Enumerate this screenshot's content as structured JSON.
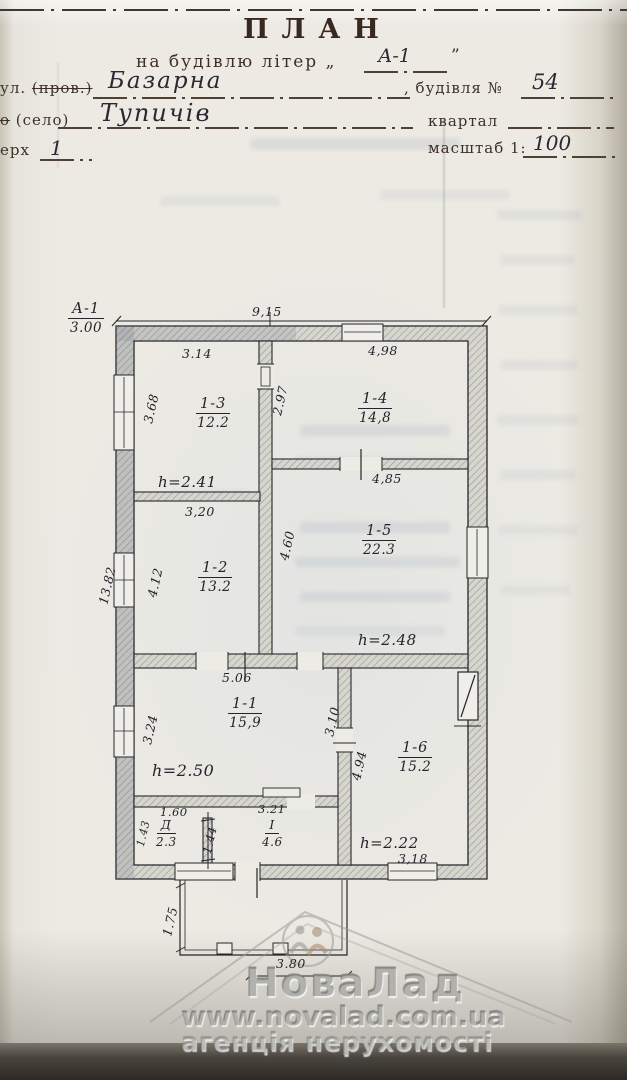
{
  "header": {
    "title": "ПЛАН",
    "subtitle": "на будівлю літер „",
    "subtitle_close_quote": "”",
    "letter_value": "А-1",
    "row_street": {
      "label_prefix": "ул. ",
      "label_struck": "(пров.)",
      "value": "Базарна",
      "right_label": ", будівля №",
      "right_value": "54"
    },
    "row_settlement": {
      "label_struck": "о",
      "label": " (село)",
      "value": "Тупичів",
      "right_label": "квартал",
      "right_value": ""
    },
    "row_floor": {
      "label": "ерх",
      "value": "1",
      "right_label": "масштаб 1:",
      "right_value": "100"
    }
  },
  "plan": {
    "section_mark": {
      "letter": "А-1",
      "value": "3.00"
    },
    "dims": {
      "overall_top": "9,15",
      "overall_left": "13.82",
      "r13_top": "3.14",
      "r13_left": "3.68",
      "r13_h": "h=2.41",
      "door_13_14": "2.97",
      "r14_top": "4,98",
      "r15_top": "4,85",
      "r15_left": "4.60",
      "r15_h": "h=2.48",
      "r12_top": "3,20",
      "r12_left": "4.12",
      "r11_top": "5.06",
      "r11_left": "3.24",
      "r11_h": "h=2.50",
      "r16_right_upper": "3.10",
      "r16_left": "4.94",
      "r16_h": "h=2.22",
      "r16_bottom": "3,18",
      "rd_top": "1.60",
      "rd_left": "1.43",
      "rd_divider": "1.44",
      "ri_top": "3.21",
      "porch_left": "1.75",
      "porch_bottom": "3.80"
    },
    "rooms": {
      "r13": {
        "id": "1-3",
        "area": "12.2"
      },
      "r14": {
        "id": "1-4",
        "area": "14,8"
      },
      "r15": {
        "id": "1-5",
        "area": "22.3"
      },
      "r12": {
        "id": "1-2",
        "area": "13.2"
      },
      "r11": {
        "id": "1-1",
        "area": "15,9"
      },
      "r16": {
        "id": "1-6",
        "area": "15.2"
      },
      "rd": {
        "id": "Д",
        "area": "2.3"
      },
      "ri": {
        "id": "I",
        "area": "4.6"
      }
    }
  },
  "watermark": {
    "brand": "НоваЛад",
    "url": "www.novalad.com.ua",
    "tagline": "агенція нерухомості"
  }
}
